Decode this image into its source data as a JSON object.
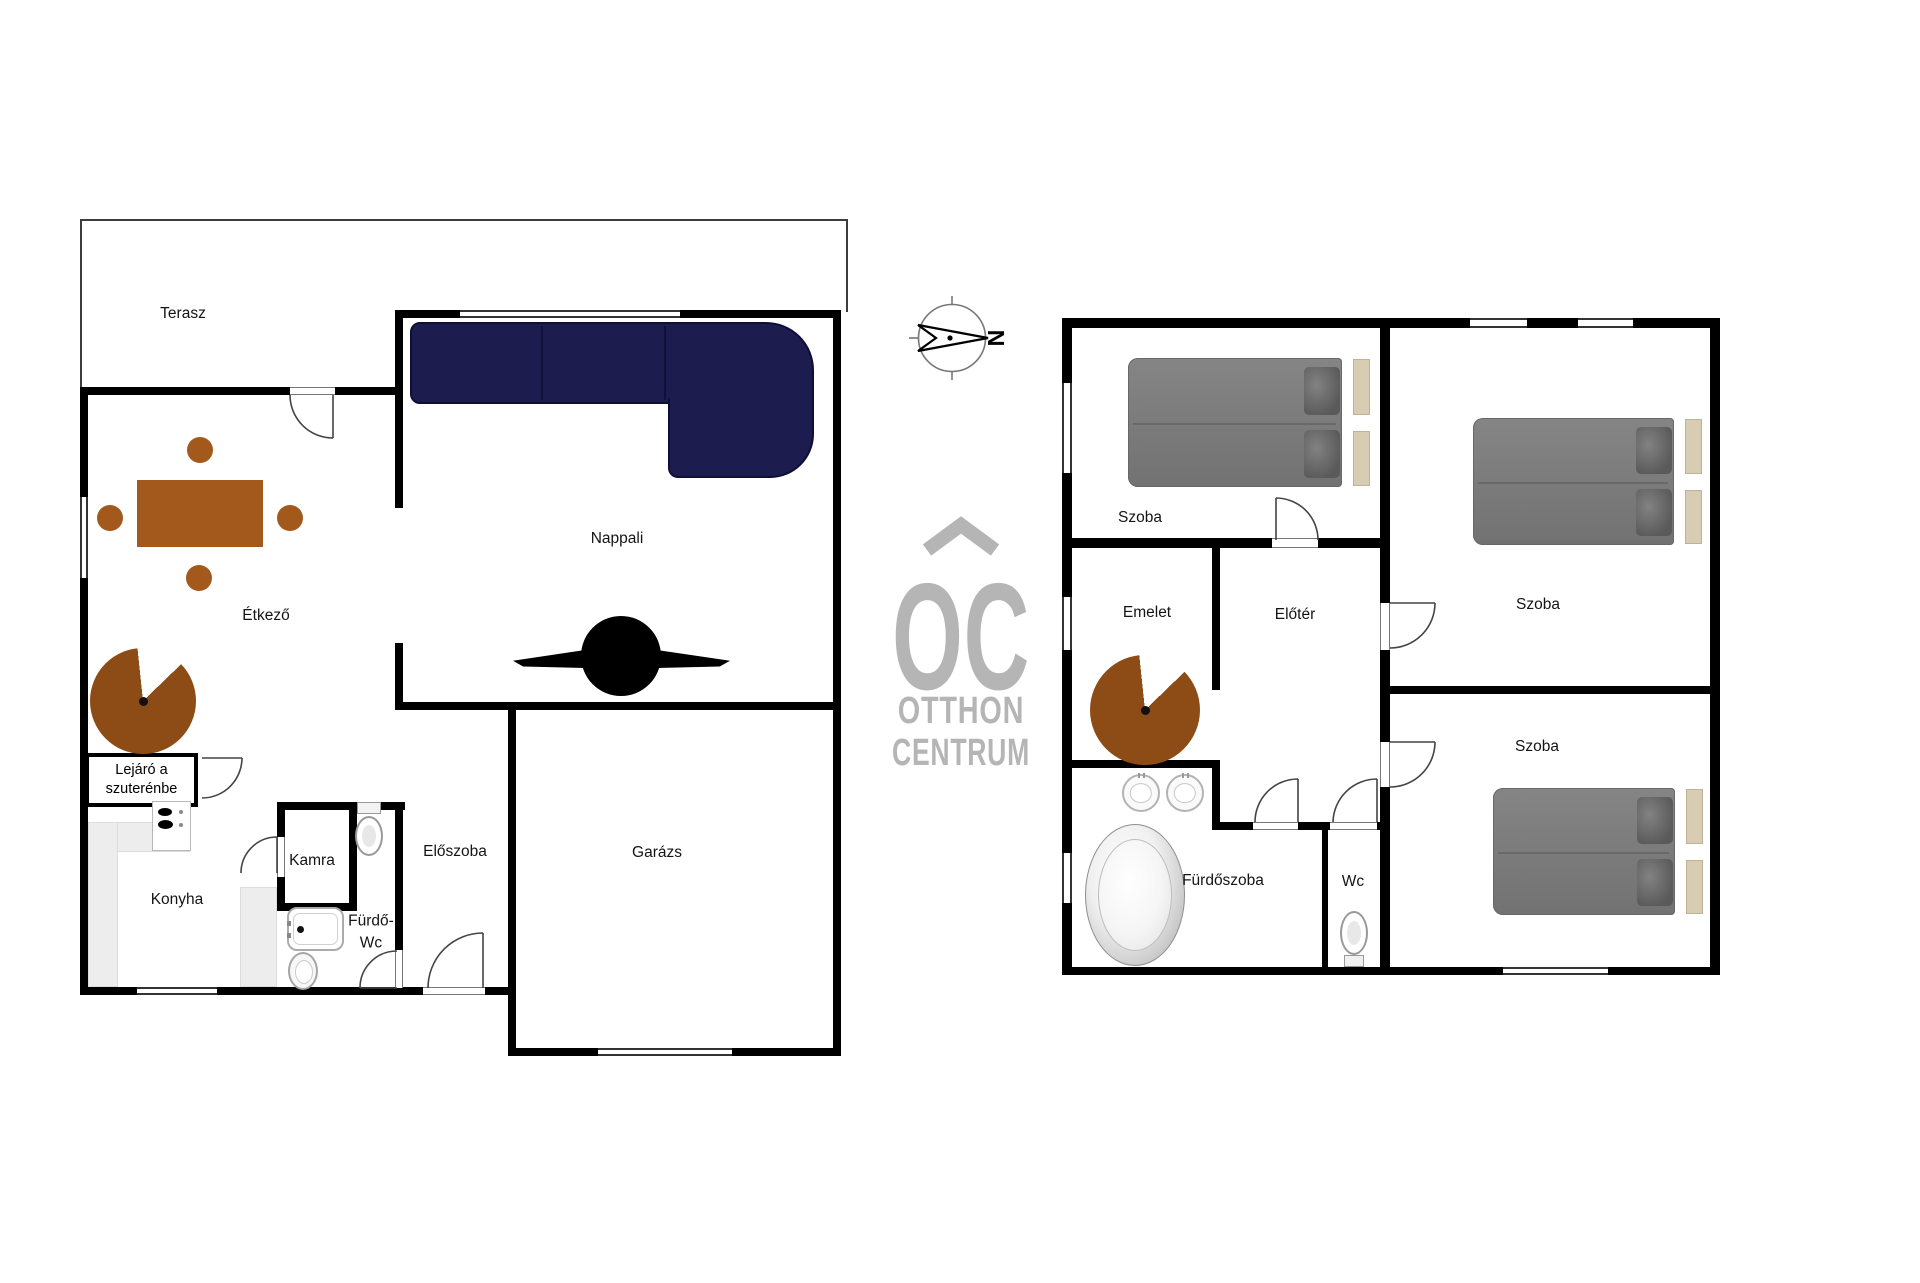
{
  "canvas": {
    "width": 1920,
    "height": 1283,
    "background": "#ffffff"
  },
  "colors": {
    "wall": "#000000",
    "wood_table": "#a3591c",
    "stair_wood": "#8d4c16",
    "sofa_navy": "#1c1c4e",
    "bed_gray": "#7b7b7b",
    "pillow_gray": "#5a5a5a",
    "headboard_beige": "#d8cdb3",
    "counter_gray": "#ededed",
    "logo_gray": "#b5b5b5"
  },
  "compass": {
    "north_label": "N"
  },
  "logo": {
    "monogram": "OC",
    "name_line1": "OTTHON",
    "name_line2": "CENTRUM"
  },
  "ground_floor": {
    "labels": {
      "terasz": "Terasz",
      "etkezo": "Étkező",
      "nappali": "Nappali",
      "konyha": "Konyha",
      "kamra": "Kamra",
      "furdo_wc_line1": "Fürdő-",
      "furdo_wc_line2": "Wc",
      "eloszoba": "Előszoba",
      "garazs": "Garázs",
      "basement_line1": "Lejáró a",
      "basement_line2": "szuterénbe"
    }
  },
  "upper_floor": {
    "labels": {
      "szoba": "Szoba",
      "emelet": "Emelet",
      "eloter": "Előtér",
      "furdoszoba": "Fürdőszoba",
      "wc": "Wc"
    }
  }
}
